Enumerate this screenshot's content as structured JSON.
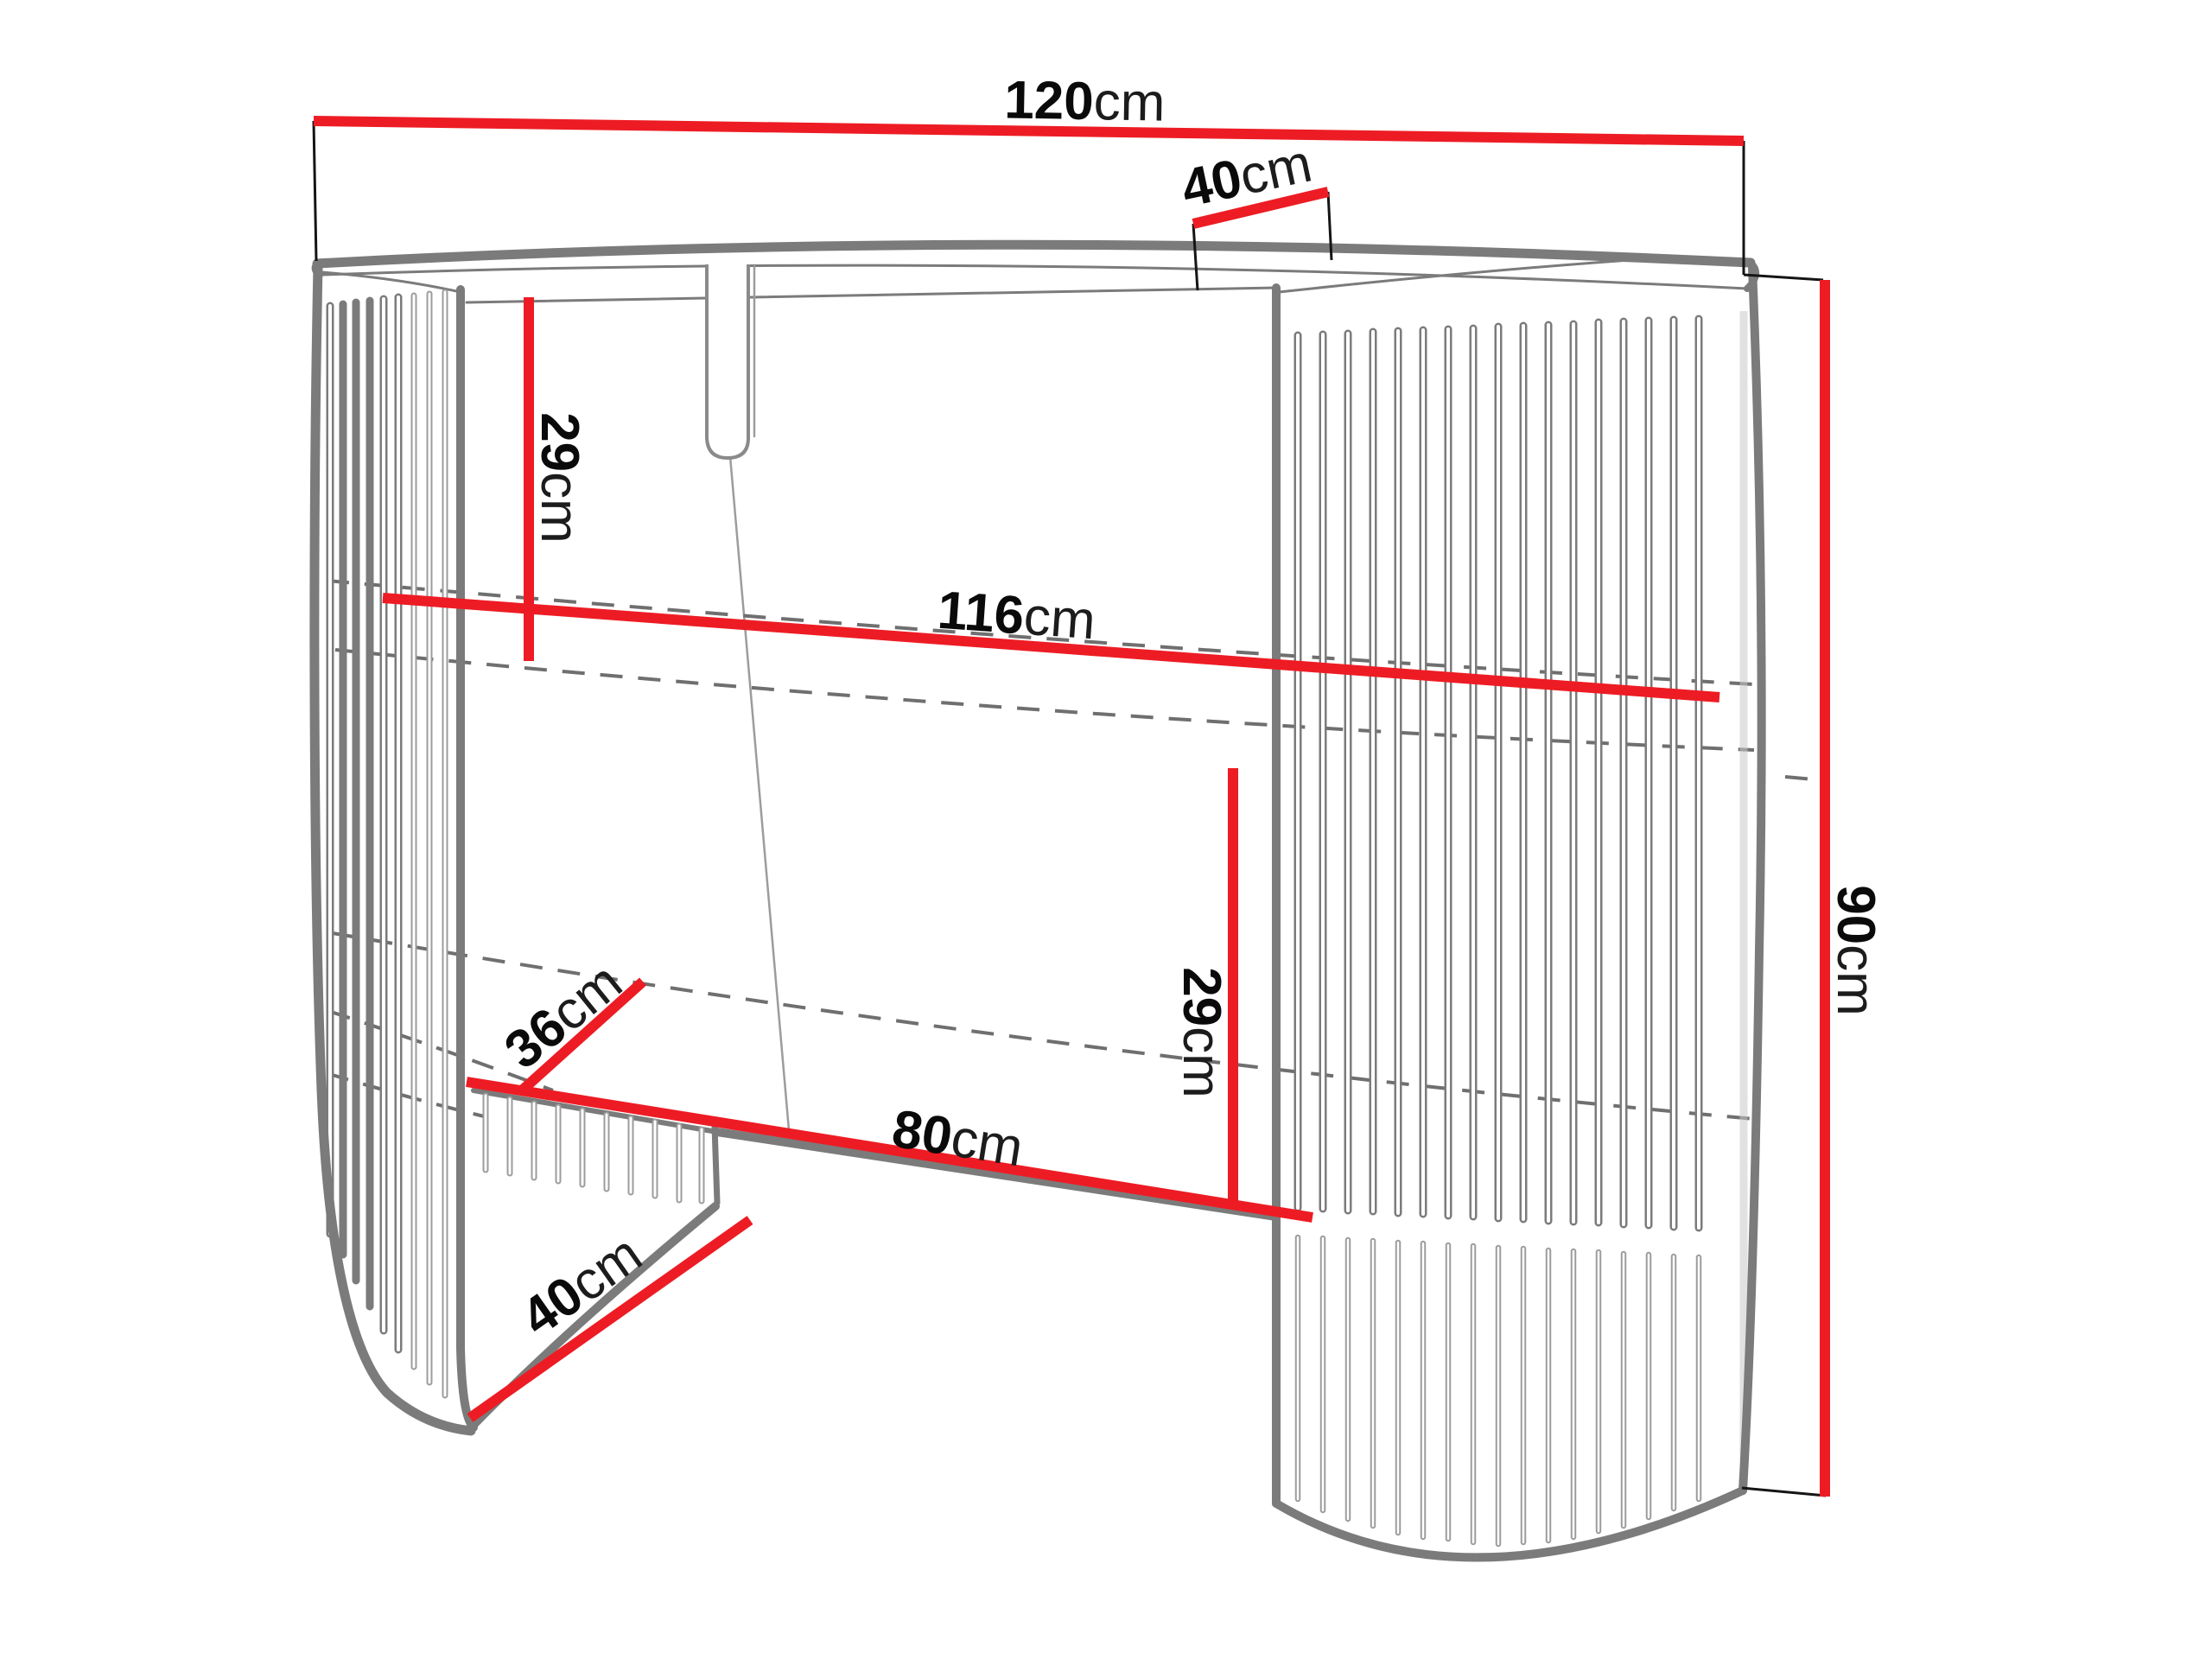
{
  "diagram": {
    "kind": "furniture dimension drawing",
    "object": "fluted oval console table with two slatted pedestals",
    "unit": "cm"
  },
  "colors": {
    "dimension": "#ed1c24",
    "outline": "#7b7b7b",
    "outline-light": "#9c9c9c",
    "dashed": "#6f6f6f",
    "label": "#0a0a0a",
    "background": "#ffffff"
  },
  "dims": {
    "top_width": {
      "value": "120",
      "unit": "cm"
    },
    "top_depth": {
      "value": "40",
      "unit": "cm"
    },
    "top_to_shelf_height": {
      "value": "29",
      "unit": "cm"
    },
    "shelf_width": {
      "value": "116",
      "unit": "cm"
    },
    "shelf_depth": {
      "value": "36",
      "unit": "cm"
    },
    "opening_width": {
      "value": "80",
      "unit": "cm"
    },
    "shelf_to_base_height": {
      "value": "29",
      "unit": "cm"
    },
    "pedestal_depth": {
      "value": "40",
      "unit": "cm"
    },
    "total_height": {
      "value": "90",
      "unit": "cm"
    }
  }
}
